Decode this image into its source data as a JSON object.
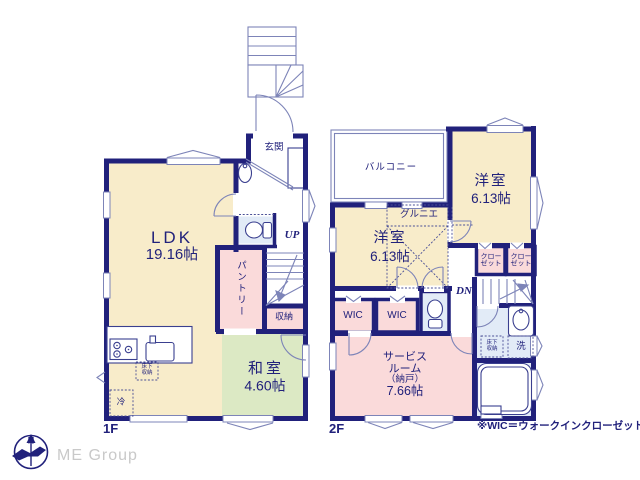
{
  "colors": {
    "wall_navy": "#21217b",
    "room_cream": "#f8ecca",
    "room_pink": "#fadada",
    "room_green": "#dce9c4",
    "room_blue": "#e2ebf7",
    "thin_line": "#7d84b8",
    "logo_gray": "#c9c9c9"
  },
  "floor1": {
    "label": "1F",
    "entrance_label": "玄関",
    "ldk_name": "LDK",
    "ldk_size": "19.16帖",
    "pantry_label": "パントリー",
    "storage_label": "収納",
    "washitsu_name": "和室",
    "washitsu_size": "4.60帖",
    "underfloor_line1": "床下",
    "underfloor_line2": "収納",
    "fridge_label": "冷",
    "stairs_up_label": "UP"
  },
  "floor2": {
    "label": "2F",
    "balcony_label": "バルコニー",
    "bedroom_right_name": "洋室",
    "bedroom_right_size": "6.13帖",
    "bedroom_left_name": "洋室",
    "bedroom_left_size": "6.13帖",
    "grenier_label": "グルニエ",
    "closet1_line1": "クロー",
    "closet1_line2": "ゼット",
    "closet2_line1": "クロー",
    "closet2_line2": "ゼット",
    "wic1_label": "WIC",
    "wic2_label": "WIC",
    "stairs_down_label": "DN",
    "service_line1": "サービス",
    "service_line2": "ルーム",
    "service_line3": "（納戸）",
    "service_size": "7.66帖",
    "underfloor_line1": "床下",
    "underfloor_line2": "収納",
    "laundry_label": "洗"
  },
  "footer": {
    "note": "※WIC＝ウォークインクローゼット",
    "logo_text": "ME Group",
    "compass_label": "N"
  }
}
